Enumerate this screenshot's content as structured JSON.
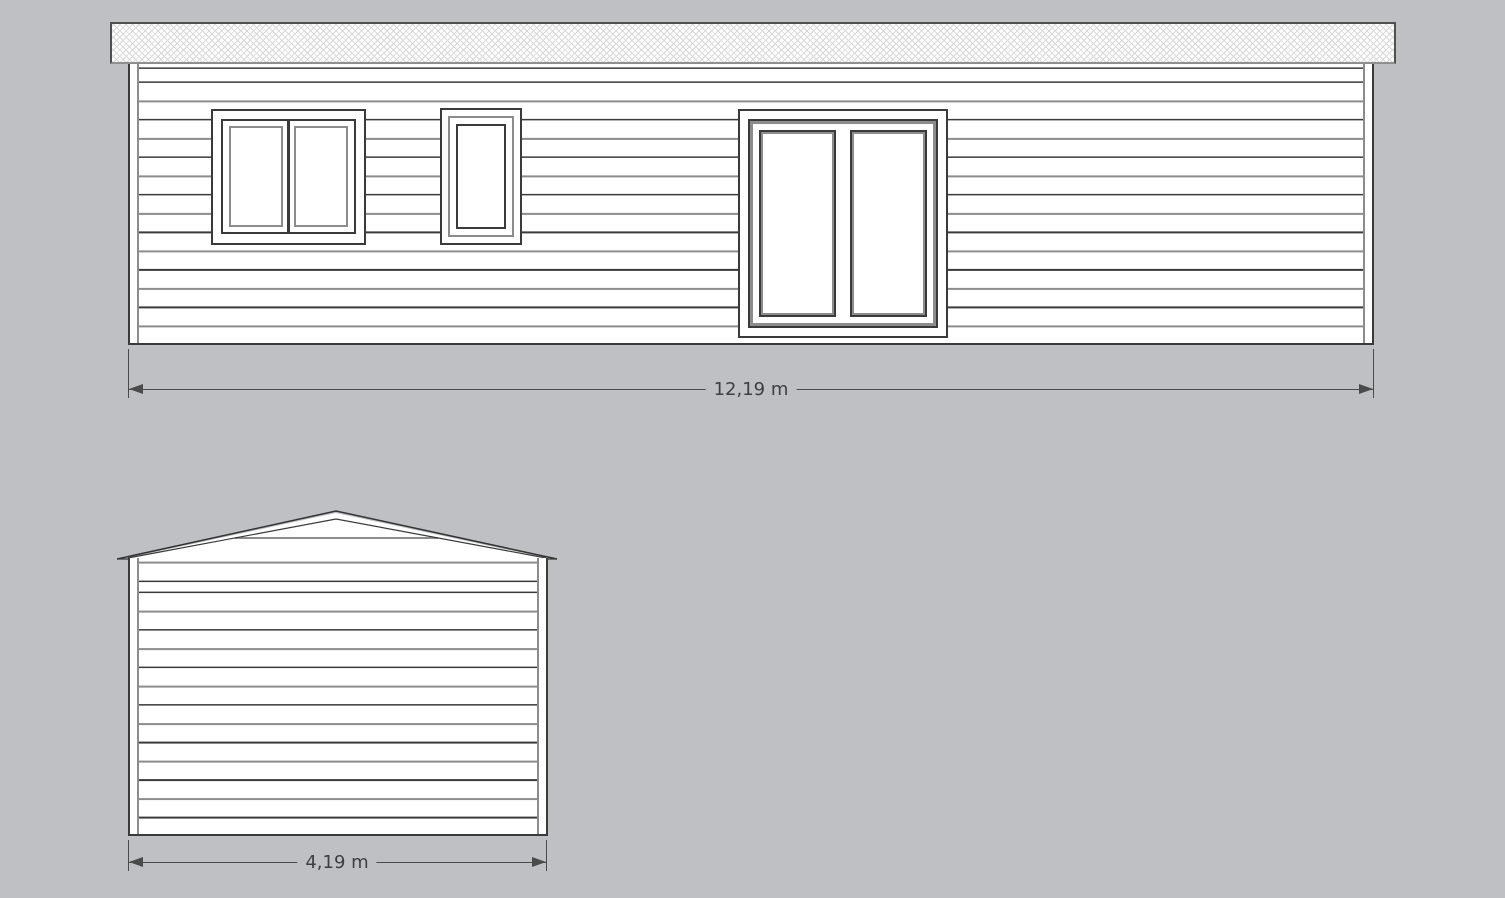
{
  "colors": {
    "background": "#bec0c4",
    "line_dark": "#3a3a3a",
    "line_gray": "#8c8c8c",
    "hatch": "#d8d8d8",
    "dim_text": "#3c3e43",
    "dim_line": "#4a4a4a",
    "wall_fill": "#ffffff"
  },
  "front_elevation": {
    "dimension_label": "12,19 m"
  },
  "side_elevation": {
    "dimension_label": "4,19 m"
  }
}
